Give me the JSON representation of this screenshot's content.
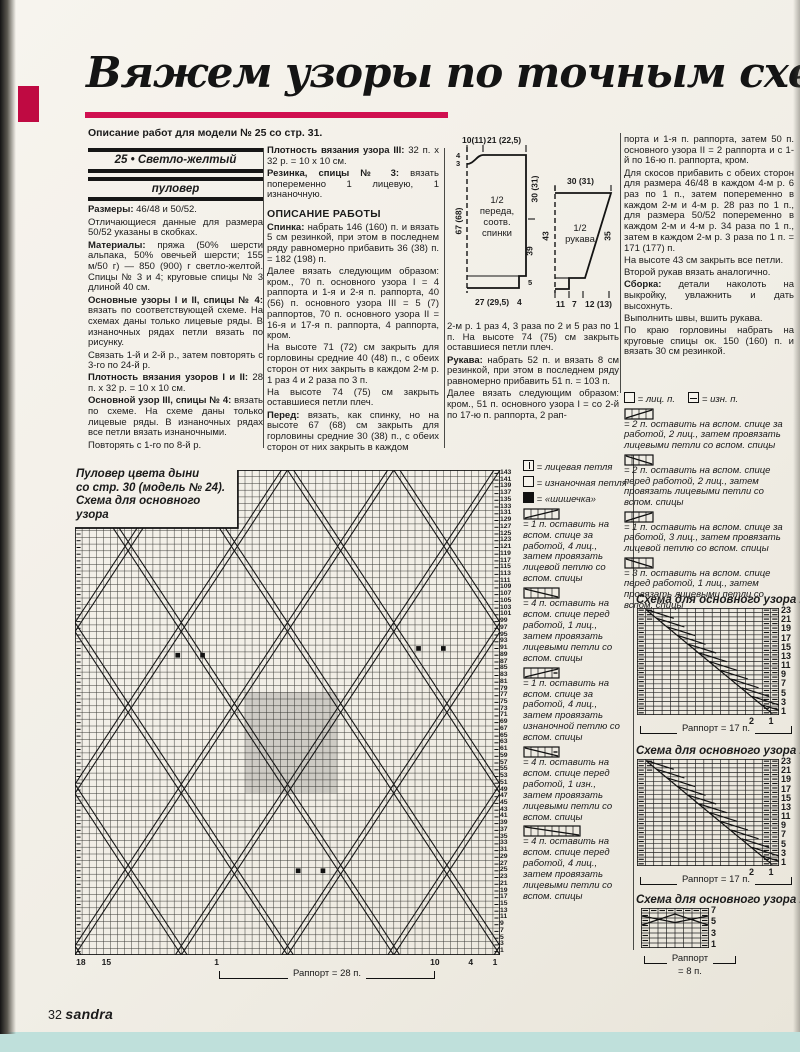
{
  "header": {
    "title": "Вяжем узоры по точным схемам",
    "subtitle": "Описание работ для модели № 25 со стр. 31."
  },
  "accent": {
    "red": "#d01050",
    "paper": "#f1eee6",
    "scan_background_cyan": "#bfe0db",
    "ink": "#1b1b1b"
  },
  "col1": {
    "box1": "25 • Светло-желтый",
    "box2": "пуловер",
    "paras": [
      {
        "lead": "Размеры:",
        "text": " 46/48 и 50/52."
      },
      {
        "lead": "",
        "text": "Отличающиеся данные для размера 50/52 указаны в скобках."
      },
      {
        "lead": "Материалы:",
        "text": " пряжа (50% шерсти альпака, 50% овечьей шерсти; 155 м/50 г) — 850 (900) г светло-желтой. Спицы № 3 и 4; круговые спицы № 3 длиной 40 см."
      },
      {
        "lead": "Основные узоры I и II, спицы № 4:",
        "text": " вязать по соответствующей схеме. На схемах даны только лицевые ряды. В изнаночных рядах петли вязать по рисунку."
      },
      {
        "lead": "",
        "text": "Связать 1-й и 2-й р., затем повторять с 3-го по 24-й р."
      },
      {
        "lead": "Плотность вязания узоров I и II:",
        "text": " 28 п. х 32 р. = 10 х 10 см."
      },
      {
        "lead": "Основной узор III, спицы № 4:",
        "text": " вязать по схеме. На схеме даны только лицевые ряды. В изнаночных рядах все петли вязать изнаночными."
      },
      {
        "lead": "",
        "text": "Повторять с 1-го по 8-й р."
      }
    ]
  },
  "col2": {
    "paras_top": [
      {
        "lead": "Плотность вязания узора III:",
        "text": " 32 п. х 32 р. = 10 х 10 см."
      },
      {
        "lead": "Резинка, спицы № 3:",
        "text": " вязать попеременно 1 лицевую, 1 изнаночную."
      }
    ],
    "heading": "ОПИСАНИЕ РАБОТЫ",
    "paras": [
      {
        "lead": "Спинка:",
        "text": " набрать 146 (160) п. и вязать 5 см резинкой, при этом в последнем ряду равномерно прибавить 36 (38) п. = 182 (198) п."
      },
      {
        "lead": "",
        "text": "Далее вязать следующим образом: кром., 70 п. основного узора I = 4 раппорта и 1-я и 2-я п. раппорта, 40 (56) п. основного узора III = 5 (7) раппортов, 70 п. основного узора II = 16-я и 17-я п. раппорта, 4 раппорта, кром."
      },
      {
        "lead": "",
        "text": "На высоте 71 (72) см закрыть для горловины средние 40 (48) п., с обеих сторон от них закрыть в каждом 2-м р. 1 раз 4 и 2 раза по 3 п."
      },
      {
        "lead": "",
        "text": "На высоте 74 (75) см закрыть оставшиеся петли плеч."
      },
      {
        "lead": "Перед:",
        "text": " вязать, как спинку, но на высоте 67 (68) см закрыть для горловины средние 30 (38) п., с обеих сторон от них закрыть в каждом"
      }
    ]
  },
  "col3": {
    "paras": [
      {
        "lead": "",
        "text": "2-м р. 1 раз 4, 3 раза по 2 и 5 раз по 1 п. На высоте 74 (75) см закрыть оставшиеся петли плеч."
      },
      {
        "lead": "Рукава:",
        "text": " набрать 52 п. и вязать 8 см резинкой, при этом в последнем ряду равномерно прибавить 51 п. = 103 п."
      },
      {
        "lead": "",
        "text": "Далее вязать следующим образом: кром., 51 п. основного узора I = со 2-й по 17-ю п. раппорта, 2 рап-"
      }
    ]
  },
  "col4": {
    "paras": [
      {
        "lead": "",
        "text": "порта и 1-я п. раппорта, затем 50 п. основного узора II = 2 раппорта и с 1-й по 16-ю п. раппорта, кром."
      },
      {
        "lead": "",
        "text": "Для скосов прибавить с обеих сторон для размера 46/48 в каждом 4-м р. 6 раз по 1 п., затем попеременно в каждом 2-м и 4-м р. 28 раз по 1 п., для размера 50/52 попеременно в каждом 2-м и 4-м р. 34 раза по 1 п., затем в каждом 2-м р. 3 раза по 1 п. = 171 (177) п."
      },
      {
        "lead": "",
        "text": "На высоте 43 см закрыть все петли."
      },
      {
        "lead": "",
        "text": "Второй рукав вязать аналогично."
      },
      {
        "lead": "Сборка:",
        "text": " детали наколоть на выкройку, увлажнить и дать высохнуть."
      },
      {
        "lead": "",
        "text": "Выполнить швы, вшить рукава."
      },
      {
        "lead": "",
        "text": "По краю горловины набрать на круговые спицы ок. 150 (160) п. и вязать 30 см резинкой."
      }
    ],
    "legend": {
      "knit": "= лиц. п.",
      "purl": "= изн. п.",
      "items": [
        "= 2 п. оставить на вспом. спице за работой, 2 лиц., затем провязать лицевыми петли со вспом. спицы",
        "= 2 п. оставить на вспом. спице перед работой, 2 лиц., затем провязать лицевыми петли со вспом. спицы",
        "= 1 п. оставить на вспом. спице за работой, 3 лиц., затем провязать лицевой петлю со вспом. спицы",
        "= 3 п. оставить на вспом. спице перед работой, 1 лиц., затем провязать лицевыми петли со вспом. спицы"
      ]
    }
  },
  "schematic": {
    "p1_top1": "10(11)",
    "p1_top2": "21 (22,5)",
    "p1_neck1": "4",
    "p1_neck2": "3",
    "p1_left": "67 (68)",
    "p1_r1": "30 (31)",
    "p1_r2": "39",
    "p1_r3": "5",
    "p1_b1": "27 (29,5)",
    "p1_b2": "4",
    "p1_name": [
      "1/2",
      "переда,",
      "соотв.",
      "спинки"
    ],
    "p2_top": "30 (31)",
    "p2_left": "43",
    "p2_right": "35",
    "p2_b1": "11",
    "p2_b2": "7",
    "p2_b3": "12 (13)",
    "p2_name": [
      "1/2",
      "рукава"
    ]
  },
  "sideLegend": {
    "items": [
      "= лицевая петля",
      "= изнаночная петля",
      "= «шишечка»",
      "= 1 п. оставить на вспом. спице за работой, 4 лиц., затем провязать лицевой петлю со вспом. спицы",
      "= 4 п. оставить на вспом. спице перед работой, 1 лиц., затем провязать лицевыми петли со вспом. спицы",
      "= 1 п. оставить на вспом. спице за работой, 4 лиц., затем провязать изнаночной петлю со вспом. спицы",
      "= 4 п. оставить на вспом. спице перед работой, 1 изн., затем провязать лицевыми петли со вспом. спицы",
      "= 4 п. оставить на вспом. спице перед работой, 4 лиц., затем провязать лицевыми петли со вспом. спицы"
    ]
  },
  "bigChart": {
    "caption_lines": [
      "Пуловер цвета дыни",
      "со стр. 30 (модель № 24).",
      "Схема для основного",
      "узора"
    ],
    "cols": 60,
    "rows": 72,
    "row_numbers_from": 143,
    "row_numbers_to": 1,
    "row_numbers_step": -2,
    "bottom_ticks": [
      {
        "label": "18",
        "frac": 0.012
      },
      {
        "label": "15",
        "frac": 0.072
      },
      {
        "label": "1",
        "frac": 0.337
      },
      {
        "label": "10",
        "frac": 0.845
      },
      {
        "label": "4",
        "frac": 0.935
      },
      {
        "label": "1",
        "frac": 0.992
      }
    ],
    "rapport": "Раппорт = 28 п.",
    "dots": [
      [
        14,
        27
      ],
      [
        17.5,
        27
      ],
      [
        48,
        26
      ],
      [
        51.5,
        26
      ],
      [
        31,
        59
      ],
      [
        34.5,
        59
      ]
    ]
  },
  "smallCharts": [
    {
      "caption": "Схема для основного узора I",
      "cols": 17,
      "rows": 24,
      "row_numbers": [
        23,
        21,
        19,
        17,
        15,
        13,
        11,
        9,
        7,
        5,
        3,
        1
      ],
      "corner": "2 1",
      "rapport": "Раппорт = 17 п."
    },
    {
      "caption": "Схема для основного узора II",
      "cols": 17,
      "rows": 24,
      "row_numbers": [
        23,
        21,
        19,
        17,
        15,
        13,
        11,
        9,
        7,
        5,
        3,
        1
      ],
      "corner": "2 1",
      "rapport": "Раппорт = 17 п."
    },
    {
      "caption": "Схема для основного узора III",
      "cols": 8,
      "rows": 8,
      "row_numbers": [
        7,
        5,
        3,
        1
      ],
      "rapport_line1": "Раппорт",
      "rapport_line2": "= 8 п."
    }
  ],
  "icons": {
    "knit-stitch-icon": "empty box",
    "knit-bar-stitch-icon": "box with vertical bar",
    "purl-stitch-icon": "box with horizontal dash",
    "bobble-icon": "filled black box",
    "cable-symbol-icon": "cell strip with diagonal crossing line"
  },
  "footer": {
    "page": "32",
    "brand": "sandra"
  }
}
